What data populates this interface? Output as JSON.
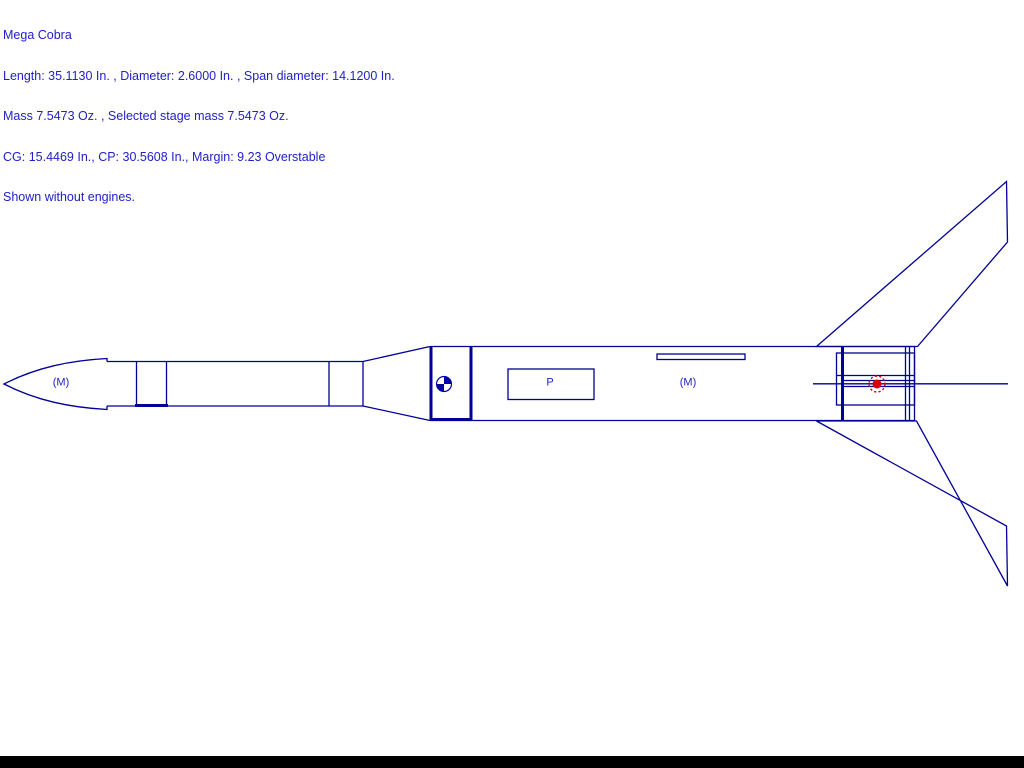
{
  "header": {
    "title": "Mega Cobra",
    "dimensions_line": "Length: 35.1130 In. , Diameter: 2.6000 In. , Span diameter: 14.1200 In.",
    "mass_line": "Mass 7.5473 Oz. , Selected stage mass 7.5473 Oz.",
    "stability_line": "CG: 15.4469 In., CP: 30.5608 In., Margin: 9.23 Overstable",
    "note_line": "Shown without engines."
  },
  "diagram": {
    "labels": {
      "nose_mass": "(M)",
      "parachute": "P",
      "body_mass": "(M)"
    },
    "colors": {
      "line": "#000096",
      "text": "#2121C8",
      "cg": "#0000A8",
      "cp": "#DE0000",
      "bg": "#FFFFFF",
      "bar": "#000000"
    }
  }
}
